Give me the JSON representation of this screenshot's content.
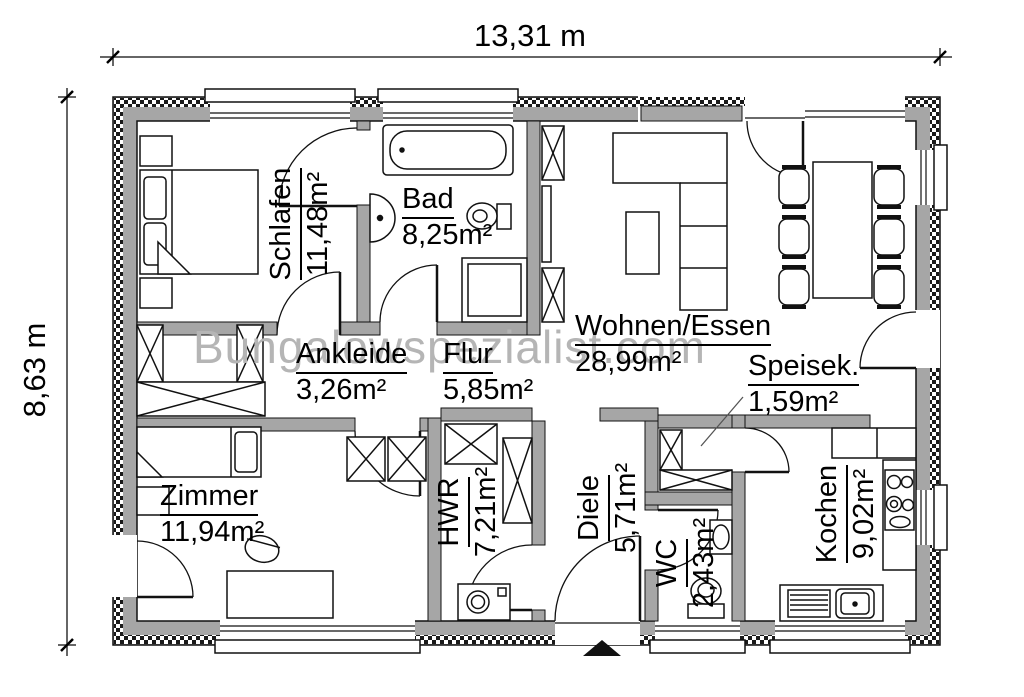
{
  "dimensions": {
    "width_label": "13,31 m",
    "depth_label": "8,63 m"
  },
  "watermark": {
    "text": "Bungalowspezialist.com"
  },
  "rooms": {
    "schlafen": {
      "name": "Schlafen",
      "area": "11,48m²",
      "orientation": "vertical"
    },
    "bad": {
      "name": "Bad",
      "area": "8,25m²",
      "orientation": "horizontal"
    },
    "wohnen": {
      "name": "Wohnen/Essen",
      "area": "28,99m²",
      "orientation": "horizontal"
    },
    "ankleide": {
      "name": "Ankleide",
      "area": "3,26m²",
      "orientation": "horizontal"
    },
    "flur": {
      "name": "Flur",
      "area": "5,85m²",
      "orientation": "horizontal"
    },
    "speisek": {
      "name": "Speisek.",
      "area": "1,59m²",
      "orientation": "horizontal"
    },
    "zimmer": {
      "name": "Zimmer",
      "area": "11,94m²",
      "orientation": "horizontal"
    },
    "hwr": {
      "name": "HWR",
      "area": "7,21m²",
      "orientation": "vertical"
    },
    "diele": {
      "name": "Diele",
      "area": "5,71m²",
      "orientation": "vertical"
    },
    "wc": {
      "name": "WC",
      "area": "2,43m²",
      "orientation": "vertical"
    },
    "kochen": {
      "name": "Kochen",
      "area": "9,02m²",
      "orientation": "vertical"
    }
  },
  "fixtures": [
    "double-bed",
    "single-bed",
    "nightstand",
    "wardrobe",
    "bathtub",
    "washbasin",
    "toilet",
    "shower",
    "tall-cabinet",
    "corner-sofa",
    "coffee-table",
    "dining-table",
    "dining-chair",
    "kitchen-counter",
    "stove",
    "kitchen-sink",
    "pantry-shelf",
    "desk",
    "desk-chair",
    "washing-machine",
    "utility-shaft",
    "entrance-arrow",
    "window",
    "door-swing"
  ],
  "colors": {
    "wall_fill": "#a6a6a6",
    "line": "#111111",
    "watermark": "#b5b5b5",
    "background": "#ffffff",
    "entrance_arrow": "#111111"
  }
}
